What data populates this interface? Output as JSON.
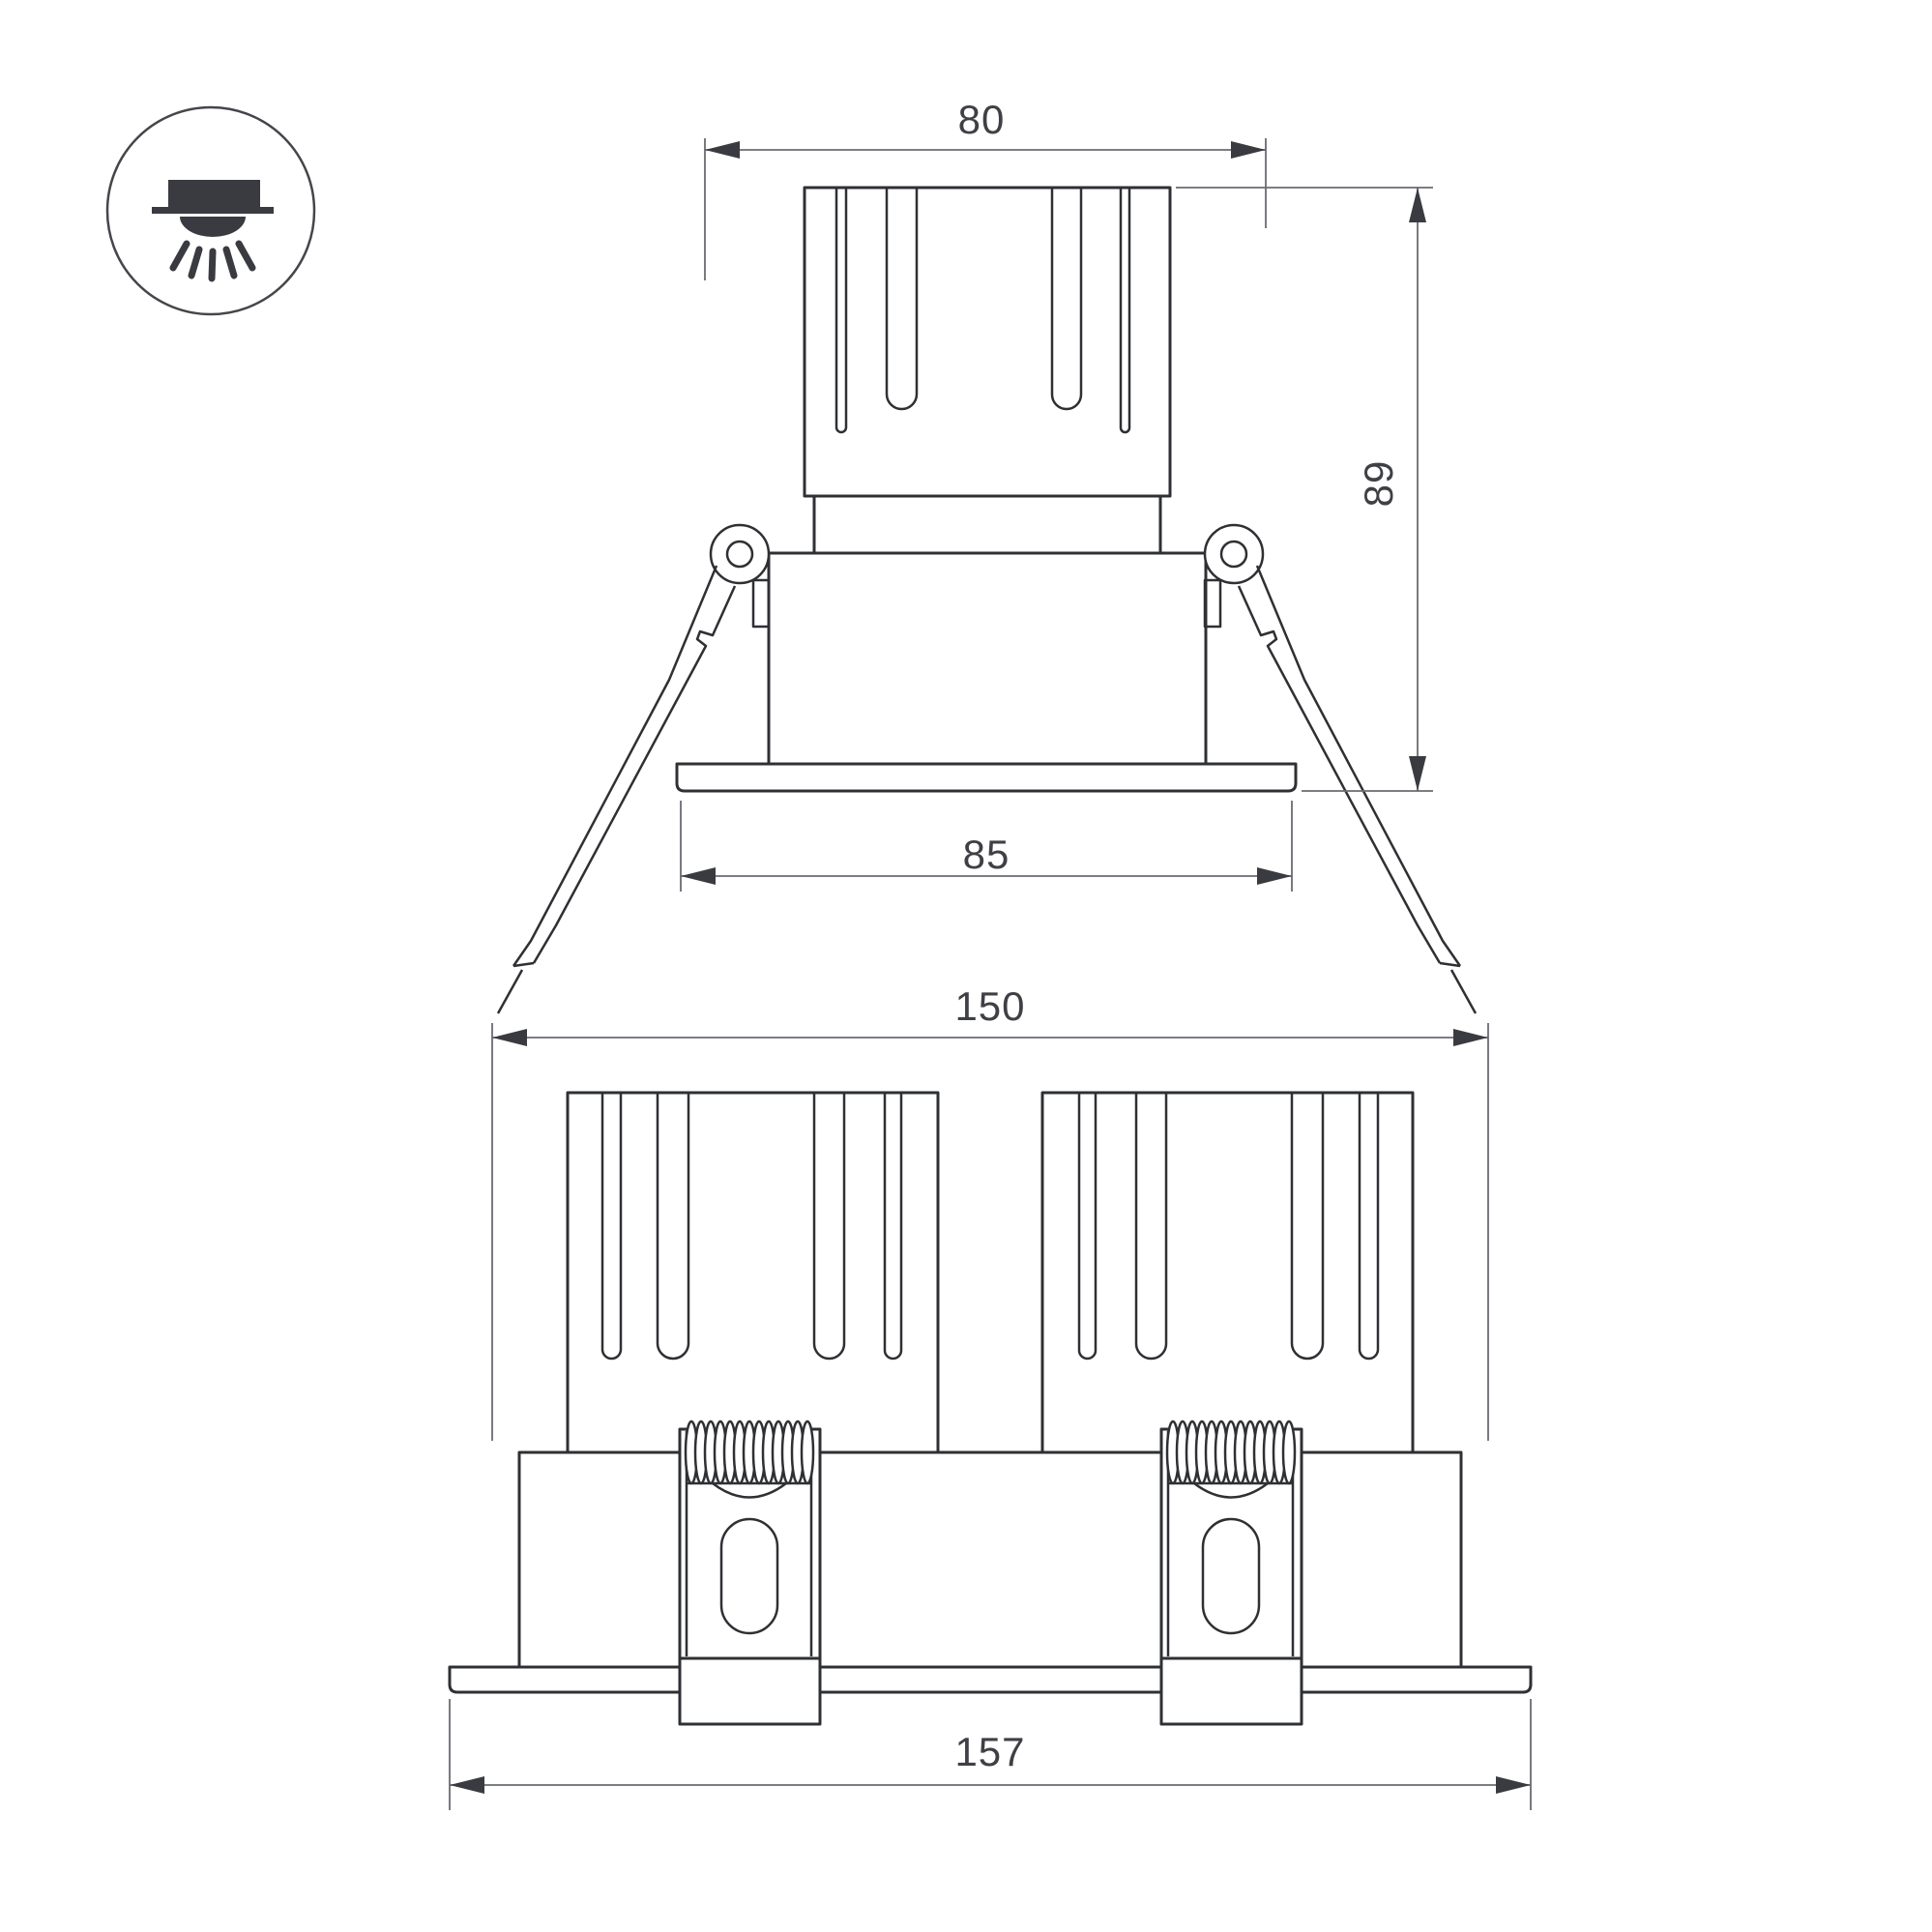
{
  "drawing": {
    "background": "#ffffff",
    "line_color": "#2f3034",
    "dim_line_color": "#6a6c72",
    "arrow_color": "#3a3b40",
    "text_color": "#3f4045",
    "icon": {
      "name": "recessed-downlight-icon"
    },
    "views": {
      "single": {
        "dims": {
          "top_width": "80",
          "height": "89",
          "flange_width": "85"
        }
      },
      "double": {
        "dims": {
          "cutout_width": "150",
          "flange_width": "157"
        }
      }
    }
  }
}
